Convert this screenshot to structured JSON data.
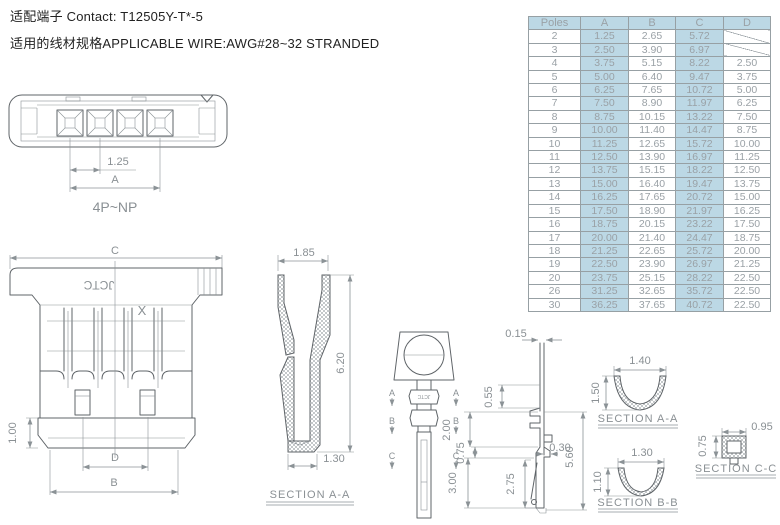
{
  "header": {
    "line1": "适配端子 Contact: T12505Y-T*-5",
    "line2": "适用的线材规格APPLICABLE WIRE:AWG#28~32 STRANDED"
  },
  "colors": {
    "table_highlight": "#bcd8e5",
    "table_grid": "#97a0a4",
    "table_text": "#9aa1a6",
    "drawing_line": "#5f6468",
    "dimension_text": "#8a9094",
    "header_text": "#222222"
  },
  "table": {
    "headers": [
      "Poles",
      "A",
      "B",
      "C",
      "D"
    ],
    "rows": [
      [
        "2",
        "1.25",
        "2.65",
        "5.72",
        ""
      ],
      [
        "3",
        "2.50",
        "3.90",
        "6.97",
        ""
      ],
      [
        "4",
        "3.75",
        "5.15",
        "8.22",
        "2.50"
      ],
      [
        "5",
        "5.00",
        "6.40",
        "9.47",
        "3.75"
      ],
      [
        "6",
        "6.25",
        "7.65",
        "10.72",
        "5.00"
      ],
      [
        "7",
        "7.50",
        "8.90",
        "11.97",
        "6.25"
      ],
      [
        "8",
        "8.75",
        "10.15",
        "13.22",
        "7.50"
      ],
      [
        "9",
        "10.00",
        "11.40",
        "14.47",
        "8.75"
      ],
      [
        "10",
        "11.25",
        "12.65",
        "15.72",
        "10.00"
      ],
      [
        "11",
        "12.50",
        "13.90",
        "16.97",
        "11.25"
      ],
      [
        "12",
        "13.75",
        "15.15",
        "18.22",
        "12.50"
      ],
      [
        "13",
        "15.00",
        "16.40",
        "19.47",
        "13.75"
      ],
      [
        "14",
        "16.25",
        "17.65",
        "20.72",
        "15.00"
      ],
      [
        "15",
        "17.50",
        "18.90",
        "21.97",
        "16.25"
      ],
      [
        "16",
        "18.75",
        "20.15",
        "23.22",
        "17.50"
      ],
      [
        "17",
        "20.00",
        "21.40",
        "24.47",
        "18.75"
      ],
      [
        "18",
        "21.25",
        "22.65",
        "25.72",
        "20.00"
      ],
      [
        "19",
        "22.50",
        "23.90",
        "26.97",
        "21.25"
      ],
      [
        "20",
        "23.75",
        "25.15",
        "28.22",
        "22.50"
      ],
      [
        "26",
        "31.25",
        "32.65",
        "35.72",
        "22.50"
      ],
      [
        "30",
        "36.25",
        "37.65",
        "40.72",
        "22.50"
      ]
    ]
  },
  "drawings": {
    "top_view": {
      "pitch": "1.25",
      "span": "A",
      "label": "4P~NP"
    },
    "front_view": {
      "width": "C",
      "latch_height": "1.00",
      "slot_span": "D",
      "body_width": "B",
      "brand": "JCTC",
      "mark": "X"
    },
    "housing_section": {
      "top_width": "1.85",
      "height": "6.20",
      "bottom_width": "1.30",
      "label": "SECTION A-A"
    },
    "terminal_front": {
      "marker_a": "A",
      "marker_b": "B",
      "marker_c": "C",
      "brand": "JCTC"
    },
    "terminal_side": {
      "d_tip": "0.15",
      "d_top": "0.55",
      "d_box": "2.00",
      "d_step": "0.75",
      "d_notch": "0.30",
      "d_crimp": "3.00",
      "d_lance": "2.75",
      "d_total": "5.60"
    },
    "section_aa": {
      "width": "1.40",
      "height": "1.50",
      "label": "SECTION A-A"
    },
    "section_bb": {
      "width": "1.30",
      "height": "1.10",
      "label": "SECTION B-B"
    },
    "section_cc": {
      "height": "0.75",
      "width": "0.95",
      "label": "SECTION C-C"
    }
  }
}
